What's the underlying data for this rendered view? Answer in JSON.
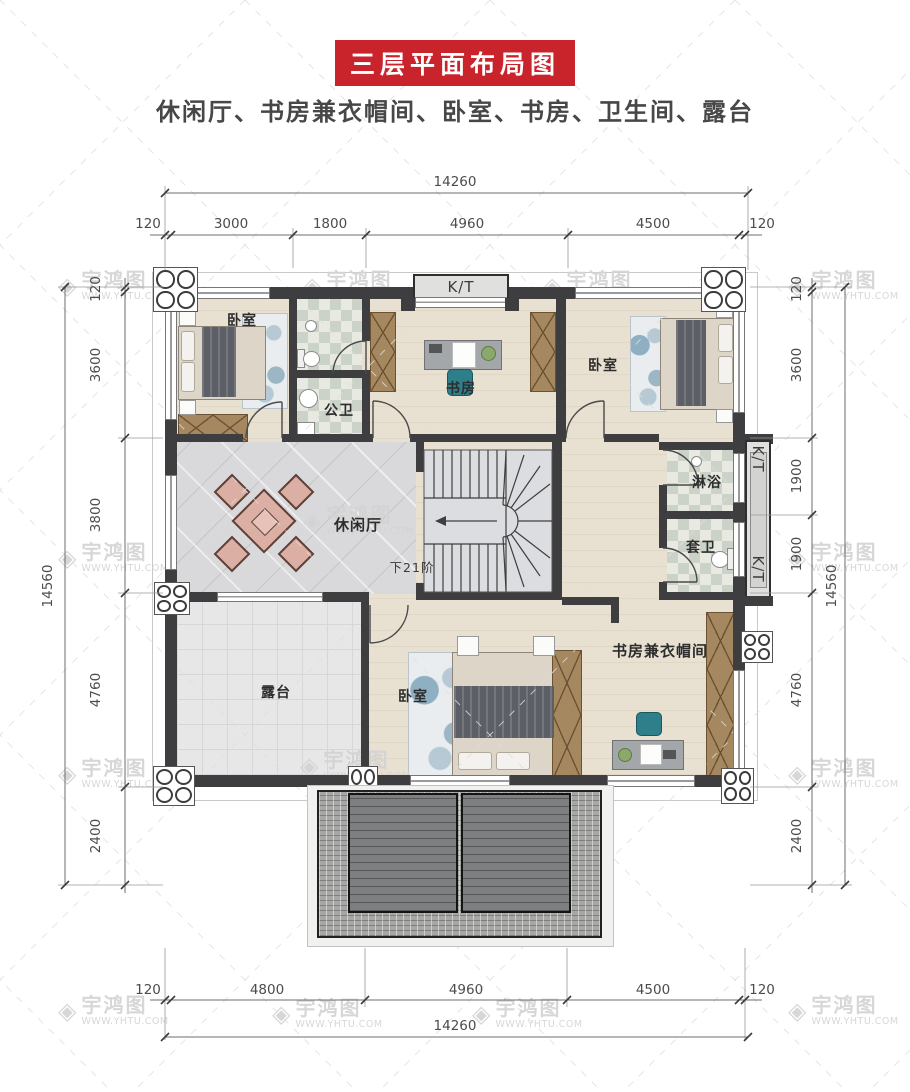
{
  "header": {
    "banner": "三层平面布局图",
    "subtitle": "休闲厅、书房兼衣帽间、卧室、书房、卫生间、露台"
  },
  "watermark": {
    "brand": "宇鸿图",
    "site": "WWW.YHTU.COM",
    "logo_icon": "diamond-icon"
  },
  "colors": {
    "banner_bg": "#c9232b",
    "banner_text": "#ffffff",
    "wall": "#3e3e41",
    "wood_floor": "#e8e0d1",
    "marble_floor": "#d9d9db",
    "tile_checker_a": "#cbd3c8",
    "tile_checker_b": "#e8e9e1",
    "terrace_tile": "#e6e7e6",
    "roof_tile": "#a7a7a6",
    "roof_panel": "#7d7f81",
    "wardrobe": "#a5885f",
    "dim_text": "#4c4c4c",
    "label_text": "#2d2d2d",
    "watermark_text": "#d3d3d3"
  },
  "dimensions": {
    "top": {
      "total": "14260",
      "segments": [
        "120",
        "3000",
        "1800",
        "4960",
        "4500",
        "120"
      ]
    },
    "bottom": {
      "total": "14260",
      "segments": [
        "120",
        "4800",
        "4960",
        "4500",
        "120"
      ]
    },
    "left": {
      "total": "14560",
      "segments": [
        "120",
        "3600",
        "3800",
        "4760",
        "2400"
      ]
    },
    "right": {
      "total": "14560",
      "segments": [
        "120",
        "3600",
        "1900",
        "1900",
        "4760",
        "2400"
      ]
    }
  },
  "rooms": {
    "bedroom_top_left": "卧室",
    "public_bathroom": "公卫",
    "study": "书房",
    "bedroom_top_right": "卧室",
    "leisure_hall": "休闲厅",
    "stairs_note": "下21阶",
    "shower_room": "淋浴",
    "ensuite_bathroom": "套卫",
    "terrace": "露台",
    "bedroom_bottom": "卧室",
    "study_cloakroom": "书房兼衣帽间",
    "kt_bay_top": "K/T",
    "kt_bay_right_upper": "K/T",
    "kt_bay_right_lower": "K/T"
  }
}
